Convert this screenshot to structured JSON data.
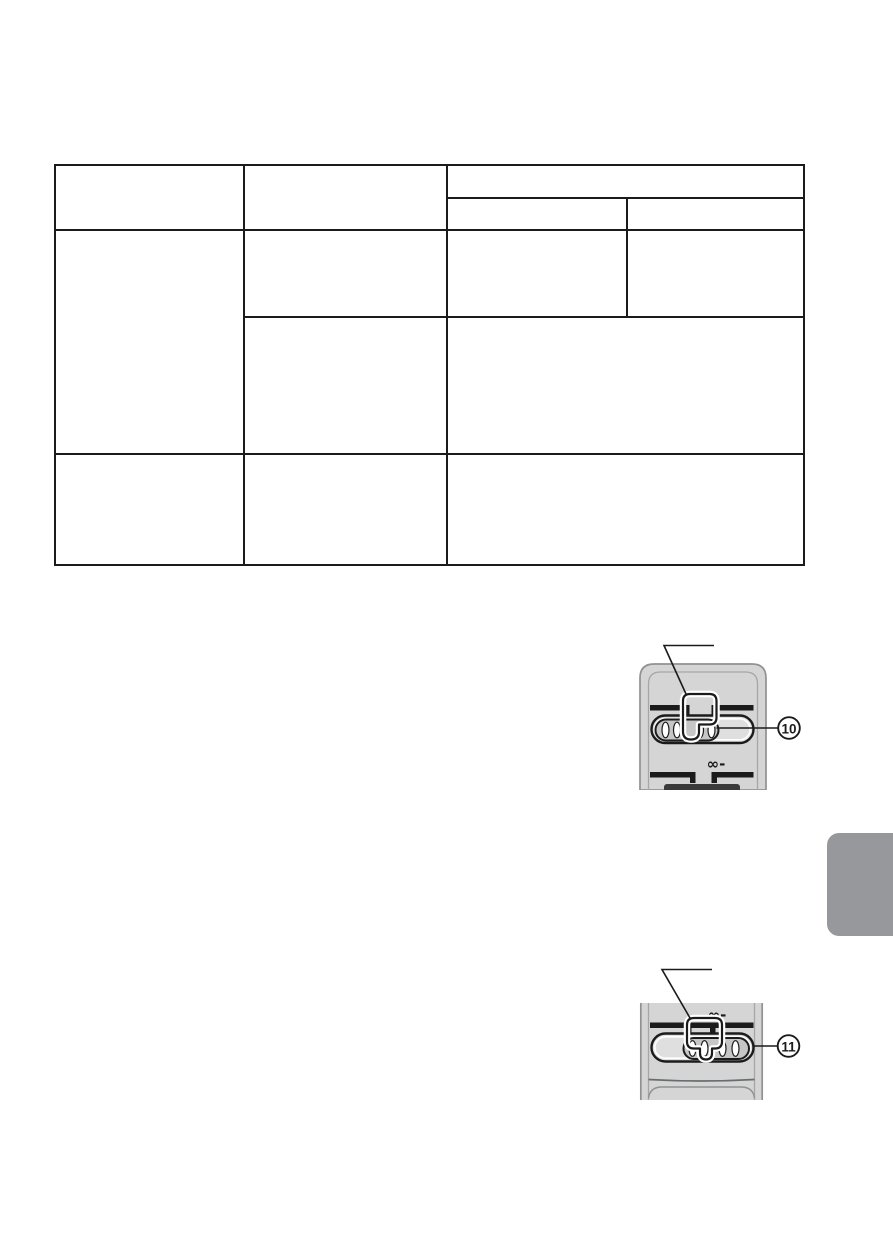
{
  "table": {
    "cells": {
      "header_col1": "",
      "header_col2": "",
      "header_span_col34": "",
      "subheader_col3": "",
      "subheader_col4": "",
      "body1_col1": "",
      "body1a_col2": "",
      "body1a_col3": "",
      "body1a_col4": "",
      "body1b_col2": "",
      "body1b_col34": "",
      "body2_col1": "",
      "body2_col2": "",
      "body2_col34": ""
    }
  },
  "figures": [
    {
      "callout_number": "10",
      "marking_label": "∞-"
    },
    {
      "callout_number": "11",
      "marking_label": "∞-"
    }
  ],
  "colors": {
    "body_gray": "#d5d5d5",
    "track_gray": "#dfdfdf",
    "knob_gray": "#c6c6c6",
    "partial_button_dark": "#3a3a3a",
    "outline_gray": "#8f9193",
    "inner_outline_gray": "#a6a6a6",
    "line_black": "#1b1b1b",
    "side_tab_gray": "#96989b"
  }
}
